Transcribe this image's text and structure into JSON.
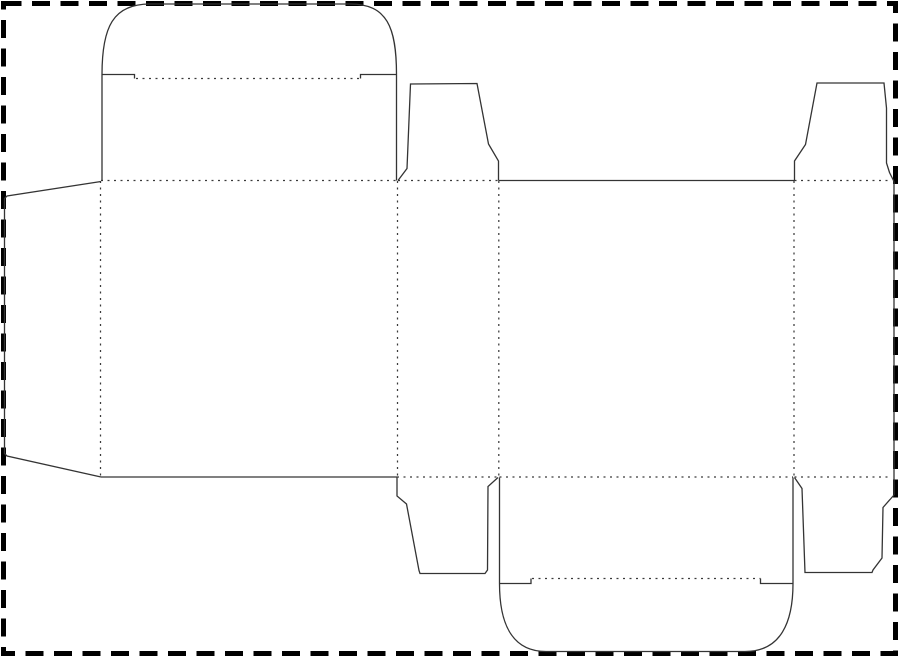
{
  "meta": {
    "title": "Tuck-end box dieline template",
    "description": "Die-cut packaging layout: solid lines are cut lines, dotted lines are fold lines, thick dashed rectangle is the sheet/crop border"
  },
  "canvas": {
    "width": 900,
    "height": 659,
    "background": "#ffffff"
  },
  "styles": {
    "cut_color": "#343434",
    "cut_width": 1.3,
    "fold_color": "#3a3a3a",
    "fold_width": 1.25,
    "fold_dash": "2 4.5",
    "border_color": "#000000",
    "border_width": 5,
    "border_dash": "18 10.5"
  },
  "border": {
    "x": 3.5,
    "y": 3.5,
    "width": 892,
    "height": 650
  },
  "cut_paths": [
    {
      "name": "top-tuck-lid-outline",
      "d": "M 102 181 L 102 74.5 C 102 27 113 4 150 4 L 350 4 C 387 4 396.5 27 396.5 74.5 L 396.5 180.5"
    },
    {
      "name": "top-lid-shoulder-left",
      "d": "M 102 74.5 L 134.5 74.5 L 134.5 78.5"
    },
    {
      "name": "top-lid-shoulder-right",
      "d": "M 360.5 78.5 L 360.5 74.5 L 396.5 74.5"
    },
    {
      "name": "glue-flap-outline",
      "d": "M 101 181.5 L 7 196 L 4.5 198.5 L 4.5 453.5 L 7 456 L 101 477"
    },
    {
      "name": "top-dust-flap-left-outline",
      "d": "M 398 180.5 L 407 168.5 L 410.5 84 L 477 83.5 L 488.5 144 L 498.5 161 L 498.5 180.5"
    },
    {
      "name": "top-dust-flap-right-outline",
      "d": "M 794.5 180.5 L 794.5 161 L 805.5 144.5 L 817 83 L 884 83 L 886.5 108 L 886.5 163 L 889.5 172.5 L 894 181.5"
    },
    {
      "name": "right-side-panel-edge",
      "d": "M 894 181.5 L 894 495"
    },
    {
      "name": "bottom-dust-flap-right-outline",
      "d": "M 894 495 L 883 507.5 L 882 558 L 873 570 L 872 572.5 L 805 572.5 L 802 488.5 L 794.5 477.5"
    },
    {
      "name": "bottom-dust-flap-left-outline",
      "d": "M 397 477.5 L 397 496 L 406.5 504 L 419 570.5 L 420 573.5 L 485 573.5 L 487.5 570 L 488 486.5 L 498 477.5"
    },
    {
      "name": "bottom-tuck-lid-outline",
      "d": "M 499.5 477.5 L 499.5 583.5 C 499.5 622 511 651.5 546 651.5 L 745 651.5 C 781 651.5 793 622 793 583.5 L 793 477.5"
    },
    {
      "name": "bottom-lid-shoulder-left",
      "d": "M 499.5 583.5 L 531 583.5 L 531 578.5"
    },
    {
      "name": "bottom-lid-shoulder-right",
      "d": "M 760.5 578.5 L 760.5 583.5 L 793 583.5"
    },
    {
      "name": "back-panel-top-edge",
      "d": "M 498.5 180.5 L 794.5 180.5"
    },
    {
      "name": "front-panel-bottom-edge",
      "d": "M 101 477 L 397 477"
    }
  ],
  "fold_paths": [
    {
      "name": "fold-top-front-panel",
      "d": "M 101 180.5 L 397 180.5"
    },
    {
      "name": "fold-top-left-dust-flap",
      "d": "M 398 180.5 L 498.5 180.5"
    },
    {
      "name": "fold-top-right-dust-flap",
      "d": "M 794.5 180.5 L 891.5 180.5"
    },
    {
      "name": "fold-bottom-left-dust-flap",
      "d": "M 397 477 L 498 477"
    },
    {
      "name": "fold-bottom-back-panel",
      "d": "M 499.5 477 L 793 477"
    },
    {
      "name": "fold-bottom-right-dust-flap",
      "d": "M 794.5 477 L 891 477"
    },
    {
      "name": "fold-glue-flap",
      "d": "M 100.5 181 L 100.5 476.5"
    },
    {
      "name": "fold-front-to-side",
      "d": "M 397.5 181 L 397.5 476.5"
    },
    {
      "name": "fold-side-to-back",
      "d": "M 498.8 181 L 498.8 476.5"
    },
    {
      "name": "fold-back-to-side",
      "d": "M 794 181 L 794 476.5"
    },
    {
      "name": "fold-top-tuck-flap",
      "d": "M 136 78.5 L 360.5 78.5"
    },
    {
      "name": "fold-bottom-tuck-flap",
      "d": "M 532 578.5 L 760.5 578.5"
    }
  ]
}
